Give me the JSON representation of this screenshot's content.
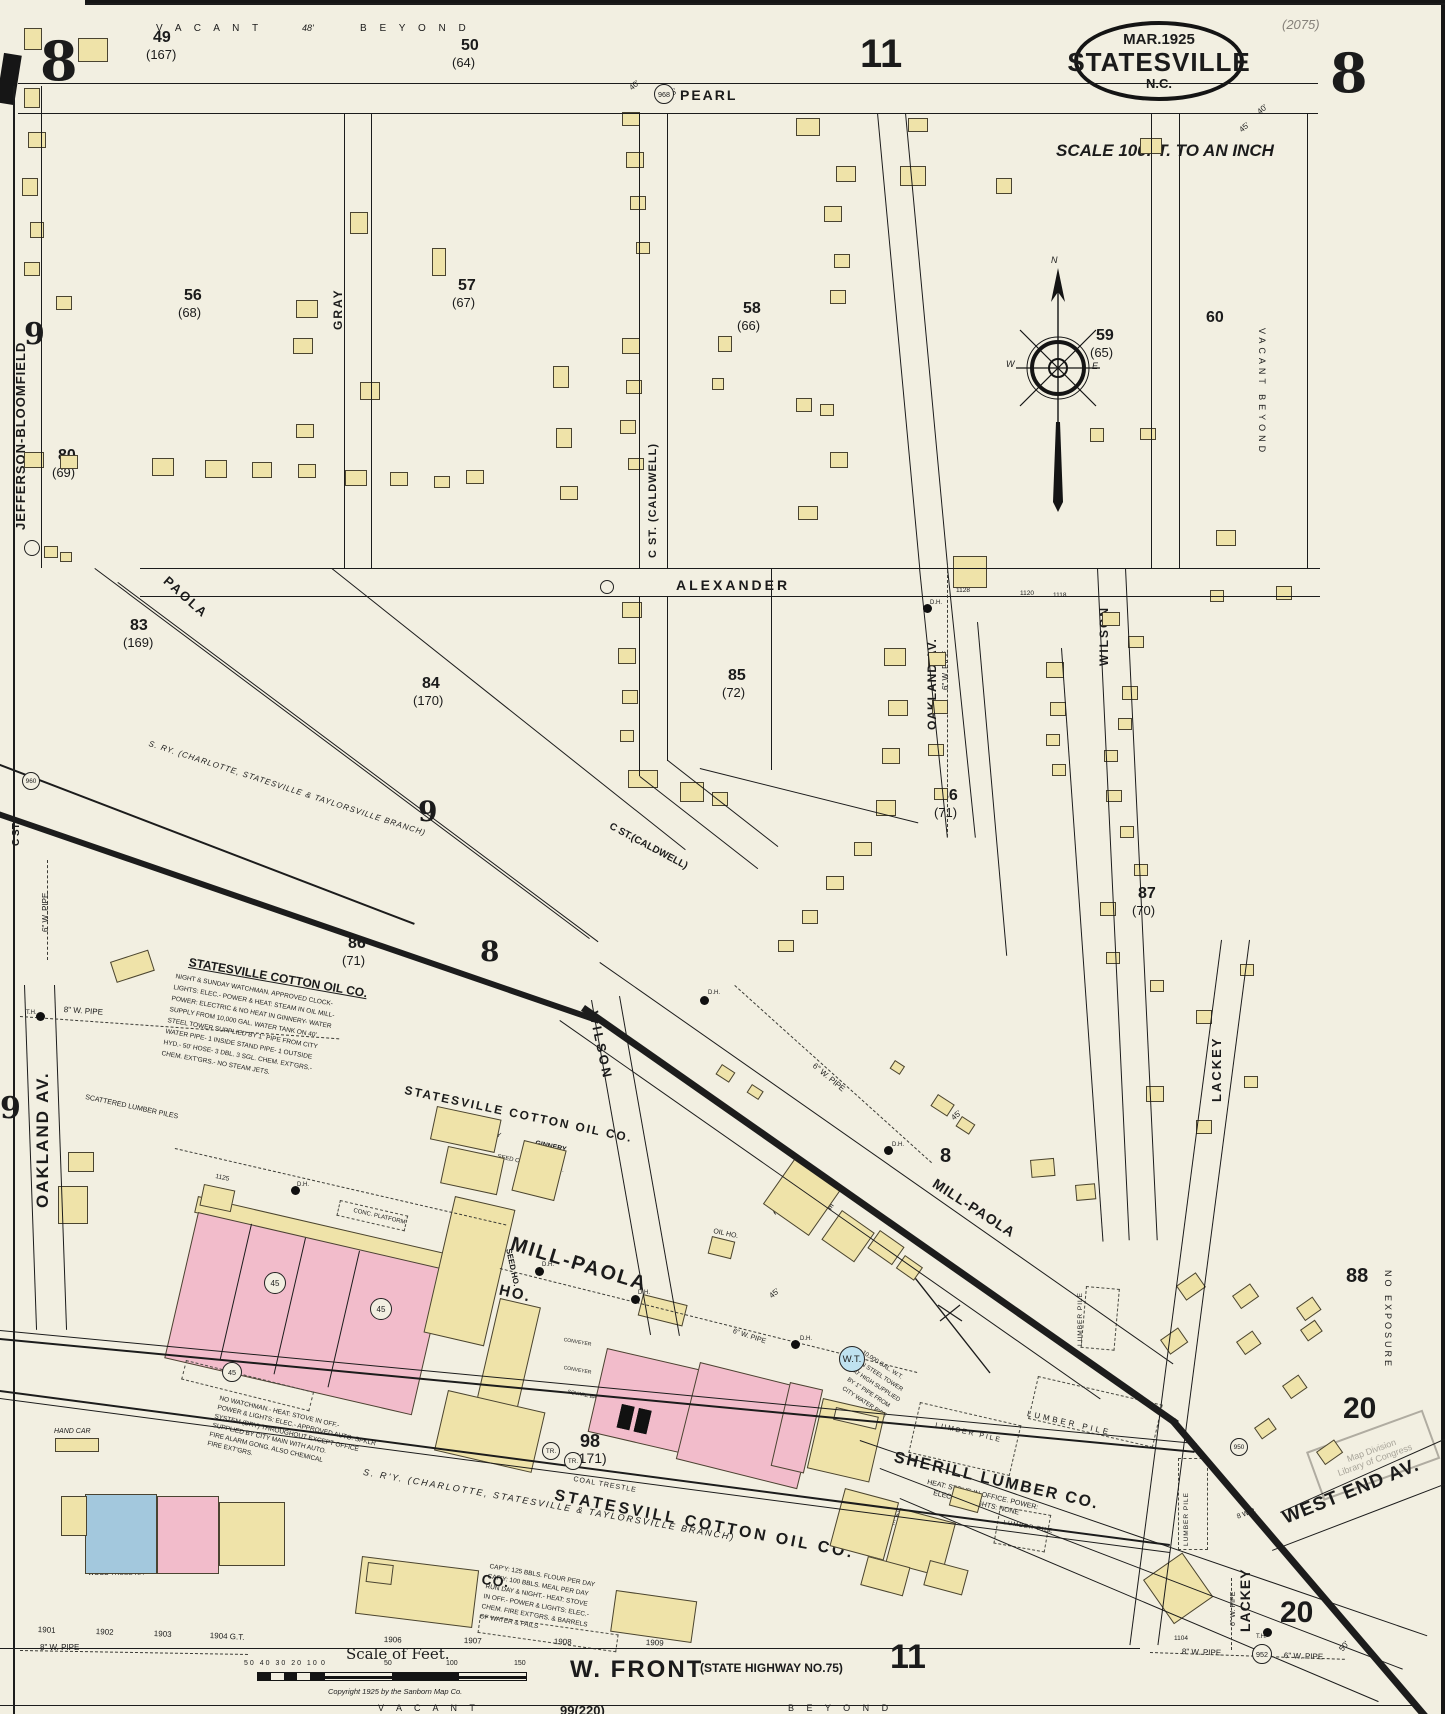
{
  "sheet": {
    "number": "8",
    "page_ref": "(2075)",
    "title_date": "MAR.1925",
    "title_city": "STATESVILLE",
    "title_state": "N.C.",
    "scale_note": "SCALE 100FT. TO AN INCH",
    "scale_bar_title": "Scale of Feet.",
    "scale_ticks_left": "50 40 30 20 10",
    "scale_tick_0": "0",
    "scale_tick_50": "50",
    "scale_tick_100": "100",
    "scale_tick_150": "150",
    "copyright": "Copyright 1925 by the Sanborn Map Co."
  },
  "blocks": {
    "num11_top": "11",
    "num11_bottom": "11",
    "left9_top": "9",
    "left9_low": "9",
    "b49": "49",
    "b49p": "(167)",
    "b50": "50",
    "b50p": "(64)",
    "b56": "56",
    "b56p": "(68)",
    "b57": "57",
    "b57p": "(67)",
    "b58": "58",
    "b58p": "(66)",
    "b59": "59",
    "b59p": "(65)",
    "b60": "60",
    "b80": "80",
    "b80p": "(69)",
    "b83": "83",
    "b83p": "(169)",
    "b84": "84",
    "b84p": "(170)",
    "b85": "85",
    "b85p": "(72)",
    "b86a": "86",
    "b86ap": "(71)",
    "b86b": "86",
    "b86bp": "(71)",
    "b87a": "87",
    "b87ap": "(70)",
    "b87b": "87",
    "b87bp": "(70)",
    "b88": "88",
    "b98": "98",
    "b98p": "(171)",
    "b99": "99(220)",
    "b20a": "20",
    "b20b": "20",
    "big8_mid": "8",
    "big9_mid": "9",
    "small8_rr": "8"
  },
  "areas": {
    "vacant_top": "V A C A N T",
    "beyond_top": "B E Y O N D",
    "vacant_bottom": "V A C A N T",
    "beyond_bottom": "B E Y O N D",
    "vacant_beyond_right": "VACANT  BEYOND",
    "no_exposure": "NO EXPOSURE",
    "scattered_lumber": "SCATTERED LUMBER PILES"
  },
  "streets": {
    "pearl": "PEARL",
    "gray": "GRAY",
    "c_st_caldwell_v": "C ST. (CALDWELL)",
    "c_st_caldwell_d": "C ST.(CALDWELL)",
    "c_st_small": "C ST.",
    "alexander": "ALEXANDER",
    "oakland_av_right": "OAKLAND AV.",
    "oakland_av_left": "OAKLAND AV.",
    "wilson_right": "WILSON",
    "wilson_lower": "WILSON",
    "paola": "PAOLA",
    "mill_paola_1": "MILL-PAOLA",
    "mill_paola_2": "MILL-PAOLA",
    "lackey_upper": "LACKEY",
    "lackey_lower": "LACKEY",
    "jefferson_bloomfield": "JEFFERSON-BLOOMFIELD",
    "west_end_av": "WEST END AV.",
    "w_front": "W. FRONT",
    "w_front_highway": "(STATE HIGHWAY NO.75)"
  },
  "railroad": {
    "sry_upper": "S. RY. (CHARLOTTE, STATESVILLE & TAYLORSVILLE BRANCH)",
    "sry_lower": "S. R'Y.  (CHARLOTTE, STATESVILLE & TAYLORSVILLE BRANCH)",
    "coal_trestle": "COAL TRESTLE"
  },
  "businesses": {
    "cotton_oil_title": "STATESVILLE COTTON OIL CO.",
    "cotton_oil_notes1": "NIGHT & SUNDAY WATCHMAN. APPROVED CLOCK-",
    "cotton_oil_notes2": "LIGHTS: ELEC.- POWER & HEAT: STEAM IN OIL MILL-",
    "cotton_oil_notes3": "POWER: ELECTRIC & NO HEAT IN GINNERY- WATER",
    "cotton_oil_notes4": "SUPPLY FROM 10,000 GAL. WATER TANK ON 40'",
    "cotton_oil_notes5": "STEEL TOWER SUPPLIED BY 1\" PIPE FROM CITY",
    "cotton_oil_notes6": "WATER PIPE- 1 INSIDE STAND PIPE- 1 OUTSIDE",
    "cotton_oil_notes7": "HYD.- 50' HOSE- 3 DBL. 3 SGL. CHEM. EXT'GRS.-",
    "cotton_oil_notes8": "CHEM. EXT'GRS.- NO STEAM JETS.",
    "cotton_oil_big_upper": "STATESVILLE COTTON OIL CO.",
    "cotton_oil_big_lower": "STATESVILL COTTON OIL CO.",
    "bonded_ware_1": "STATESVILLE BONDED WARE HO.",
    "bonded_ware_2": "COTTON WARE HOS.",
    "conc_platform": "CONC. PLATFORM",
    "platform": "PLATFORM",
    "seed_ho": "SEED HO.",
    "seed_cotton_ware_ho": "SEED COT'N WARE HO.",
    "ginnery": "GINNERY",
    "storage_old_machinery_1": "STORAGE",
    "storage_old_machinery_2": "OF OLD MACHINERY",
    "oil_presses_1": "OIL PRESSES 1ST",
    "oil_presses_2": "10 LINTERS 2ND",
    "cake_hull": "CAKE & HULL HO.",
    "cotton_seed_hulls_1": "COTTON SEED HULLS",
    "cotton_seed_hulls_2": "STORAGE",
    "square_bale_press": "SQUARE BALE PRESS",
    "conveyer": "CONVEYER",
    "raised": "RAISED",
    "boilers": "BOILERS",
    "fertilizers_a": "FERTILIZERS",
    "fertilizers_b": "FERTILIZERS",
    "fertilizers_c": "FERTILIZERS",
    "cotton_storage_1": "COTTON",
    "cotton_storage_2": "STORAGE",
    "oil_ho": "OIL HO.",
    "off_a": "OFF.",
    "off_b": "OFF.",
    "off_c": "OFF.",
    "sherill_title": "SHERILL LUMBER CO.",
    "sherill_notes1": "HEAT: STOVE IN OFFICE. POWER:",
    "sherill_notes2": "ELECTRIC.  LIGHTS: NONE",
    "lumber_pile": "LUMBER PILE",
    "fertilizer_ware_ho_1": "FERTILIZER",
    "fertilizer_ware_ho_2": "WARE HO.",
    "planing_mill_1": "PLANING",
    "planing_mill_2": "MILL",
    "star_title": "STAR MILLING CO.",
    "grain_crib": "GRAIN CRIB",
    "star_notes1": "CAP'Y: 125 BBLS. FLOUR PER DAY",
    "star_notes2": "CAP'Y: 100 BBLS. MEAL PER DAY",
    "star_notes3": "RUN DAY & NIGHT.- HEAT: STOVE",
    "star_notes4": "IN OFF.- POWER & LIGHTS: ELEC.-",
    "star_notes5": "CHEM. FIRE EXT'GRS. & BARRELS",
    "star_notes6": "OF WATER & PAILS",
    "machine_shop_1": "MACHINE",
    "machine_shop_2": "SHOP &",
    "machine_shop_3": "GARAGE",
    "machine_shop_4": "CEM. FL.",
    "machine_shop_5": "CONC. WALLS",
    "machine_shop_6": "WOOD TRUSS RF.",
    "elec_mot": "ELEC. MOT.",
    "genl_s": "GEN'L. S.",
    "genl_s_sub": "CEM. FL.",
    "no_watchman1": "NO WATCHMAN.- HEAT: STOVE IN OFF.-",
    "no_watchman2": "POWER & LIGHTS: ELEC.- APPROVED AUTO. SPKLR",
    "no_watchman3": "SYSTEM (DRY) THROUGHOUT EXCEPT OFFICE",
    "no_watchman4": "SUPPLIED BY CITY MAIN WITH AUTO.",
    "no_watchman5": "FIRE ALARM GONG. ALSO CHEMICAL",
    "no_watchman6": "FIRE EXT'GRS.",
    "sunday_school_1": "SUNDAY",
    "sunday_school_2": "SCHOOL",
    "tool_ho_1": "TOOL",
    "tool_ho_2": "HO.",
    "hand_car": "HAND CAR",
    "wt": "W.T.",
    "wt_note1": "10,000 GAL. W.T.",
    "wt_note2": "ON STEEL TOWER",
    "wt_note3": "40' HIGH SUPPLIED",
    "wt_note4": "BY 1\" PIPE FROM",
    "wt_note5": "CITY WATER PIPE"
  },
  "pipes": {
    "p8w": "8\" W. PIPE",
    "p6w": "6\" W. PIPE",
    "p8wp_small": "8 W.P.",
    "dh": "D.H.",
    "th": "T.H."
  },
  "markers": {
    "hyd_968": "968",
    "hyd_960": "960",
    "hyd_950": "950",
    "hyd_952": "952",
    "fw45": "45",
    "tr": "TR."
  },
  "compass": {
    "n": "N",
    "w": "W",
    "e": "E"
  },
  "dims": {
    "d40": "40'",
    "d45": "45'",
    "d48": "48'",
    "d50": "50'"
  },
  "house_numbers": {
    "n1901": "1901",
    "n1902": "1902",
    "n1903": "1903",
    "n1904": "1904 G.T.",
    "n1906": "1906",
    "n1907": "1907",
    "n1908": "1908",
    "n1909": "1909",
    "n1104": "1104",
    "n1118": "1118",
    "n1120": "1120",
    "n1125": "1125",
    "n1128": "1128"
  },
  "stamp": {
    "line1": "Map Division",
    "line2": "Library of Congress"
  }
}
